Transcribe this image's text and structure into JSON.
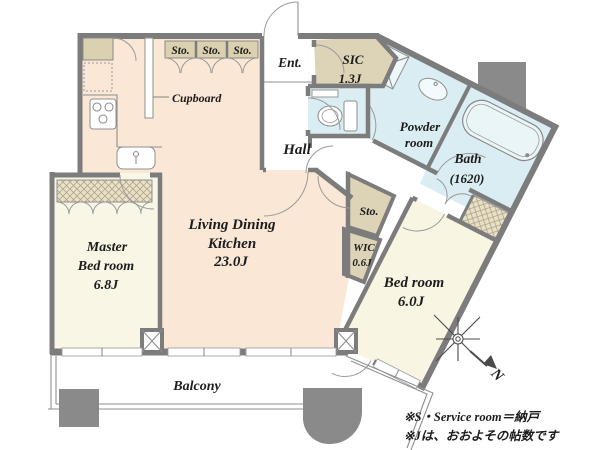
{
  "plan_title": "apartment-floor-plan",
  "colors": {
    "wall": "#7c7c7c",
    "ldk_fill": "#fae7d5",
    "room_fill": "#f8f5e3",
    "storage_fill": "#dbd1b0",
    "wet_area_fill": "#d9edf2",
    "column_fill": "#8a8a8a"
  },
  "rooms": {
    "ldk": {
      "name_line1": "Living Dining",
      "name_line2": "Kitchen",
      "size": "23.0J"
    },
    "master_bedroom": {
      "name_line1": "Master",
      "name_line2": "Bed room",
      "size": "6.8J"
    },
    "bedroom": {
      "name": "Bed room",
      "size": "6.0J"
    },
    "balcony": {
      "name": "Balcony"
    },
    "hall": {
      "name": "Hall"
    },
    "entrance": {
      "name": "Ent."
    },
    "sic": {
      "name": "SIC",
      "size": "1.3J"
    },
    "powder_room": {
      "name_line1": "Powder",
      "name_line2": "room"
    },
    "bath": {
      "name": "Bath",
      "size": "(1620)"
    },
    "wic": {
      "name": "WIC",
      "size": "0.6J"
    },
    "cupboard": {
      "name": "Cupboard"
    },
    "storage_top": [
      "Sto.",
      "Sto.",
      "Sto."
    ],
    "storage_mid": {
      "name": "Sto."
    }
  },
  "compass": {
    "north_label": "N"
  },
  "notes": {
    "line1": "※S・Service room＝納戸",
    "line2": "※Jは、おおよその帖数です"
  }
}
